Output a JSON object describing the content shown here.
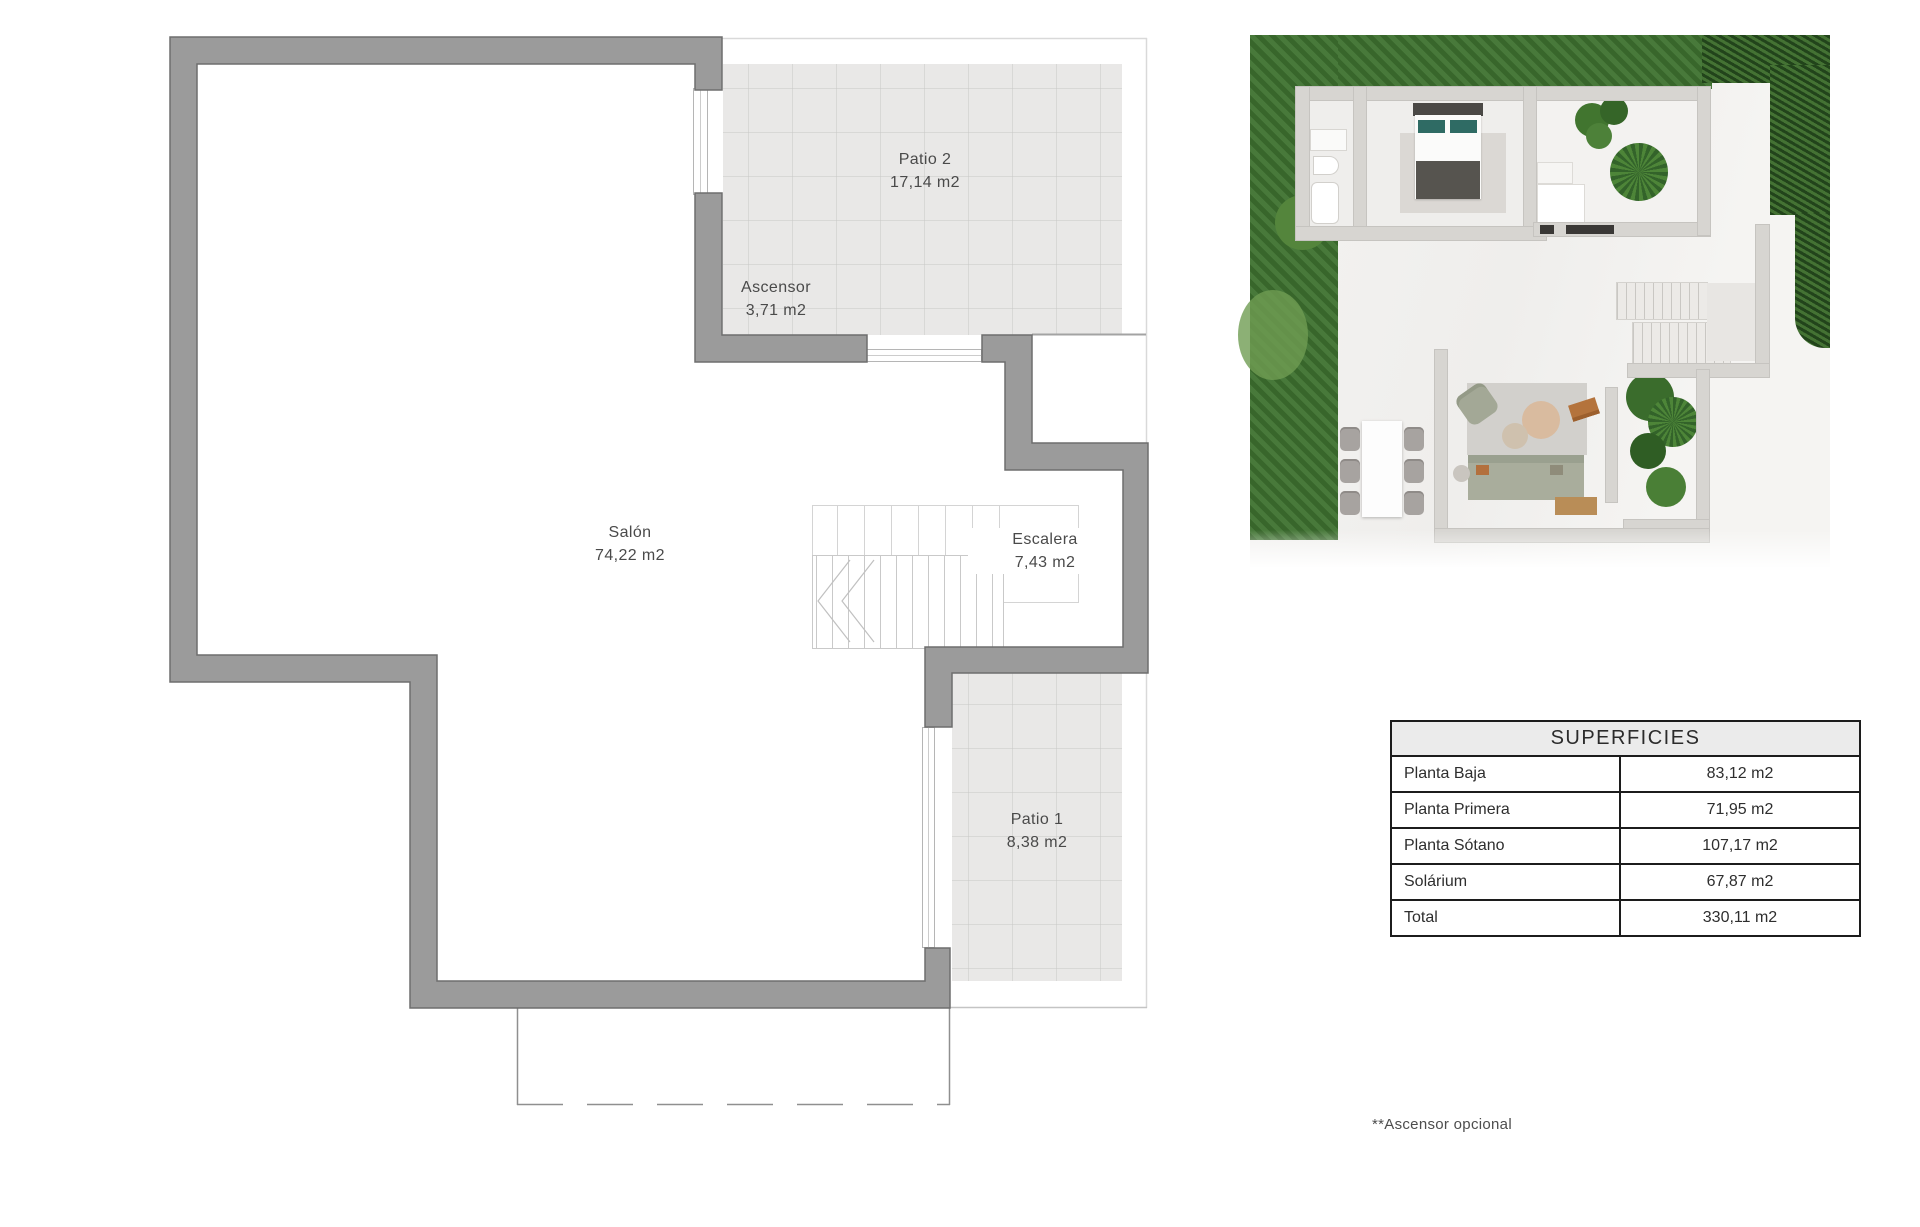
{
  "floor_plan": {
    "rooms": [
      {
        "name": "Patio 2",
        "area": "17,14 m2"
      },
      {
        "name": "Ascensor",
        "area": "3,71 m2"
      },
      {
        "name": "Salón",
        "area": "74,22 m2"
      },
      {
        "name": "Escalera",
        "area": "7,43 m2"
      },
      {
        "name": "Patio 1",
        "area": "8,38 m2"
      }
    ]
  },
  "superficies_table": {
    "title": "SUPERFICIES",
    "rows": [
      {
        "label": "Planta Baja",
        "value": "83,12 m2"
      },
      {
        "label": "Planta Primera",
        "value": "71,95 m2"
      },
      {
        "label": "Planta Sótano",
        "value": "107,17 m2"
      },
      {
        "label": "Solárium",
        "value": "67,87 m2"
      },
      {
        "label": "Total",
        "value": "330,11 m2"
      }
    ]
  },
  "footnote": "**Ascensor opcional",
  "colors": {
    "wall_gray": "#9b9b9b",
    "wall_outline": "#6e6e6e",
    "grid_fill": "#e9e8e7",
    "grid_line": "#c8c7c6",
    "table_border": "#1c1c1c",
    "table_header_bg": "#ebebeb",
    "grass_green": "#3e7230",
    "hedge_green": "#2d5a24",
    "sofa_green": "#a9ad9c",
    "pillow_teal": "#2f6b64"
  }
}
